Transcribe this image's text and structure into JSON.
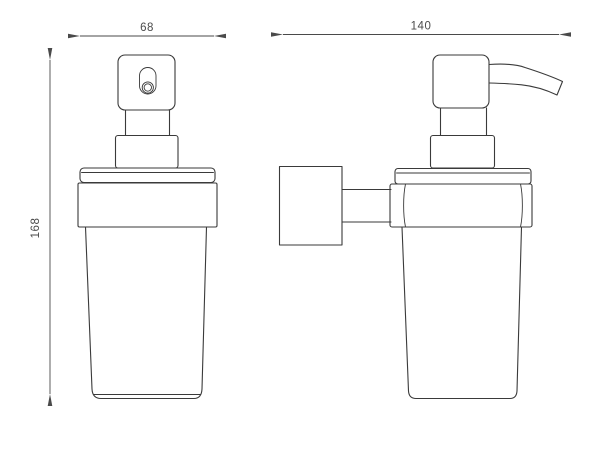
{
  "drawing": {
    "type": "technical-dimension-drawing",
    "subject": "wall-mounted-soap-dispenser",
    "views": {
      "front": "front-view",
      "side": "side-view-wall-mounted"
    },
    "dimensions": {
      "front_width": "68",
      "side_depth": "140",
      "height": "168"
    },
    "colors": {
      "line": "#3a3a3a",
      "dimension": "#4a4a4a",
      "background": "#ffffff"
    }
  }
}
